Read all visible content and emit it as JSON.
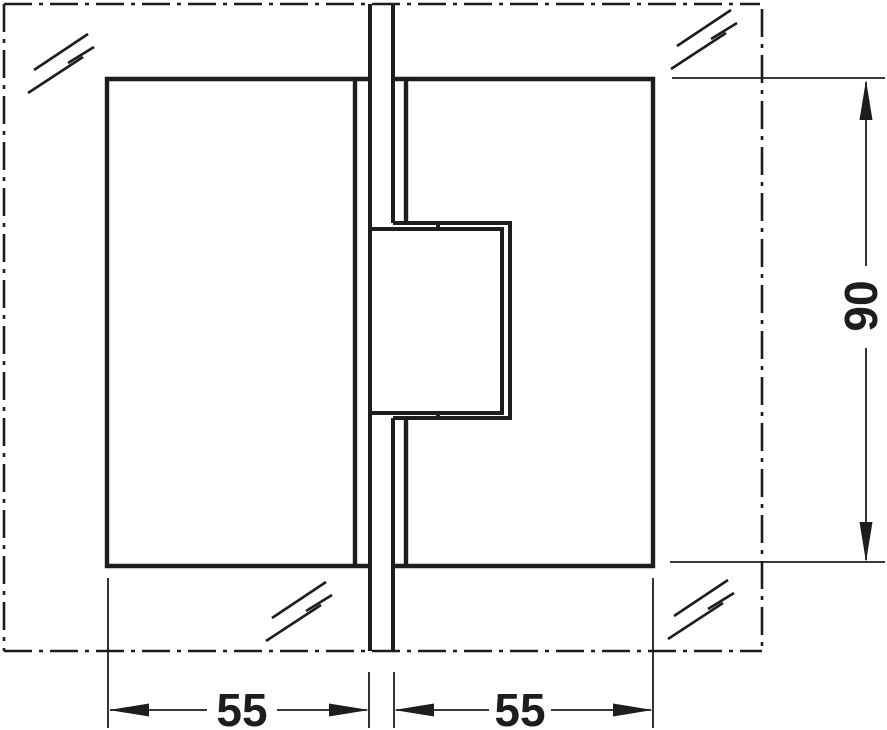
{
  "drawing": {
    "dimensions": {
      "plate_width_left": "55",
      "plate_width_right": "55",
      "plate_height": "90"
    },
    "symbols": {
      "glass_hatch": "glass-surface-indicator",
      "centerline_border": "glass-panel-cut-outline"
    },
    "colors": {
      "line": "#1d1d1b",
      "background": "#ffffff"
    }
  }
}
